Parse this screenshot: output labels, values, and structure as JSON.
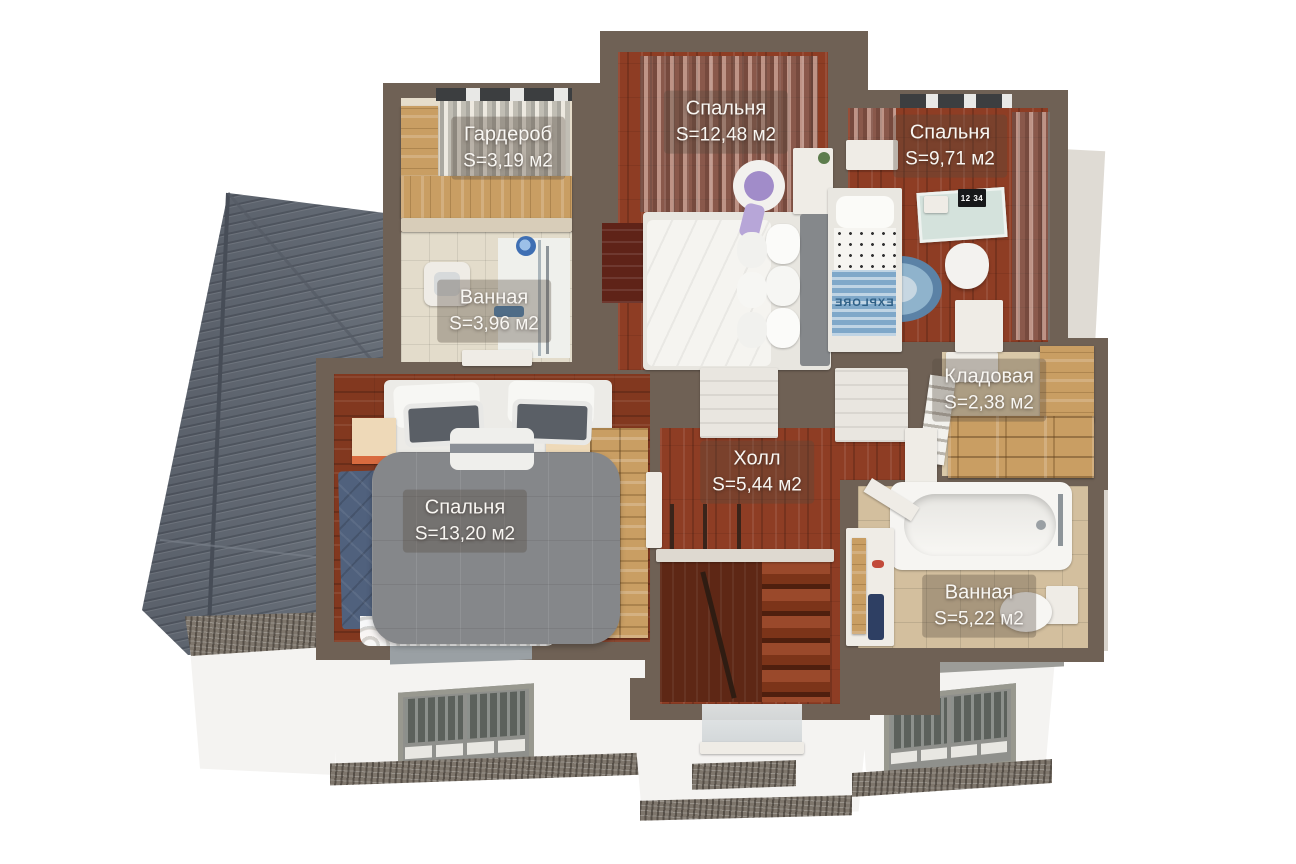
{
  "scene_title": "3D floor plan — second floor",
  "rooms": [
    {
      "id": "wardrobe",
      "name": "Гардероб",
      "area": "S=3,19 м2"
    },
    {
      "id": "bedroom-large",
      "name": "Спальня",
      "area": "S=12,48 м2"
    },
    {
      "id": "bedroom-kids",
      "name": "Спальня",
      "area": "S=9,71 м2"
    },
    {
      "id": "bathroom-small",
      "name": "Ванная",
      "area": "S=3,96 м2"
    },
    {
      "id": "storage",
      "name": "Кладовая",
      "area": "S=2,38 м2"
    },
    {
      "id": "bedroom-master",
      "name": "Спальня",
      "area": "S=13,20 м2"
    },
    {
      "id": "hall",
      "name": "Холл",
      "area": "S=5,44 м2"
    },
    {
      "id": "bathroom-big",
      "name": "Ванная",
      "area": "S=5,22 м2"
    }
  ],
  "decor": {
    "desk_screen_text": "12 34",
    "blanket_text": "EXPLORE"
  },
  "colors": {
    "wall": "#6f6155",
    "roof": "#5d636d",
    "floor_wood": "#8e3d24",
    "floor_tile": "#d3bf9e",
    "wood_light": "#c99e63",
    "carpet_blue": "#50617d",
    "blanket_blue": "#7fa8c9",
    "facade_white": "#f4f3f1",
    "label_text": "#f8f6f2"
  }
}
